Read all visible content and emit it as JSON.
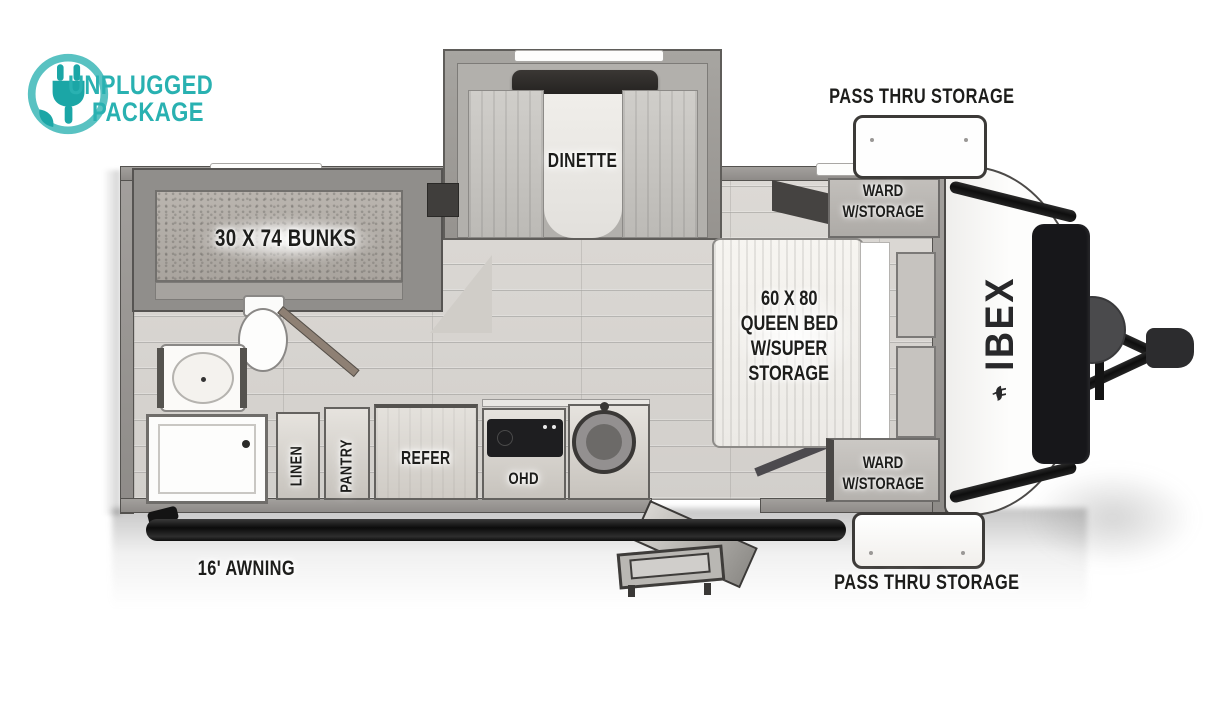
{
  "canvas": {
    "width": 1206,
    "height": 715,
    "background": "#ffffff"
  },
  "branding": {
    "unplugged_package": {
      "line1": "UNPLUGGED",
      "line2": "PACKAGE",
      "color": "#29b1b1",
      "icon": "plug-in-circle-icon"
    },
    "ibex": {
      "text": "IBEX",
      "icon": "goat-icon",
      "color": "#28282a"
    }
  },
  "exterior": {
    "pass_thru_storage_top": "PASS THRU STORAGE",
    "pass_thru_storage_bottom": "PASS THRU STORAGE",
    "awning": "16' AWNING"
  },
  "interior": {
    "dinette": "DINETTE",
    "bunks": "30 X 74 BUNKS",
    "queen_bed": {
      "lines": [
        "60 X 80",
        "QUEEN BED",
        "W/SUPER",
        "STORAGE"
      ]
    },
    "ward_top": {
      "lines": [
        "WARD",
        "W/STORAGE"
      ]
    },
    "ward_bottom": {
      "lines": [
        "WARD",
        "W/STORAGE"
      ]
    },
    "linen": "LINEN",
    "pantry": "PANTRY",
    "refer": "REFER",
    "ohd": "OHD"
  },
  "palette": {
    "label_ink": "#1d1d1b",
    "wall_gray": "#96938f",
    "floor_gray": "#d9d6d2",
    "awning_black": "#141414",
    "accent_teal": "#29b1b1"
  }
}
